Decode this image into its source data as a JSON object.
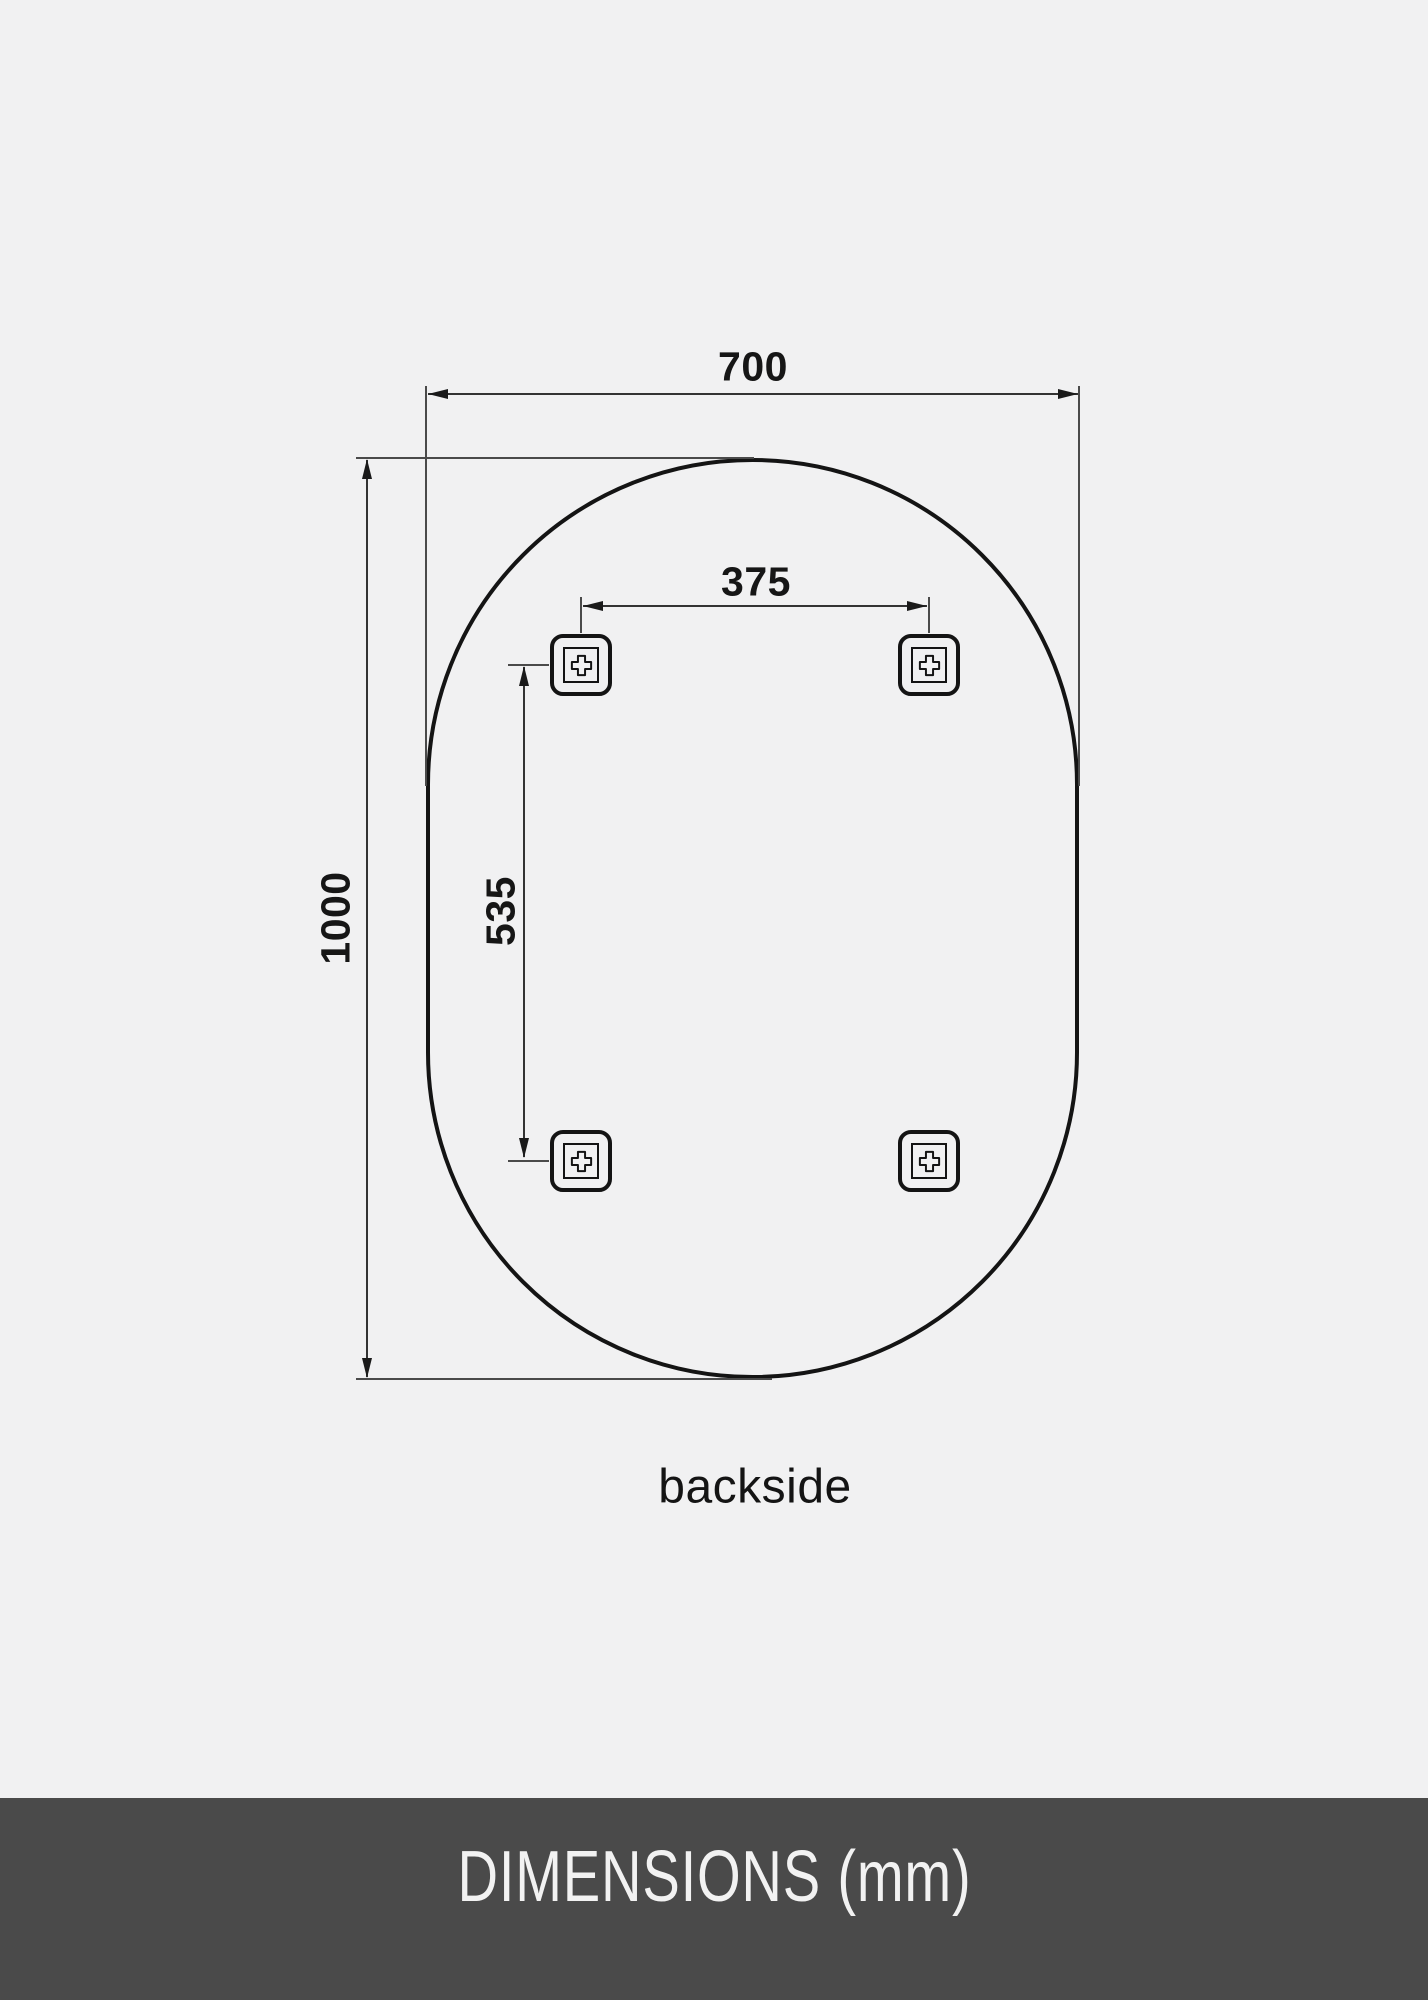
{
  "diagram": {
    "view_label": "backside",
    "overall_width_mm": "700",
    "overall_height_mm": "1000",
    "bracket_spacing_horizontal_mm": "375",
    "bracket_spacing_vertical_mm": "535",
    "shape": "oval-pill-mirror",
    "bracket_count": 4
  },
  "footer": {
    "title": "DIMENSIONS (mm)"
  },
  "colors": {
    "background": "#f1f1f2",
    "line": "#1a1a1a",
    "footer_background": "#4a4a4a",
    "footer_text": "#f2f2f2"
  }
}
